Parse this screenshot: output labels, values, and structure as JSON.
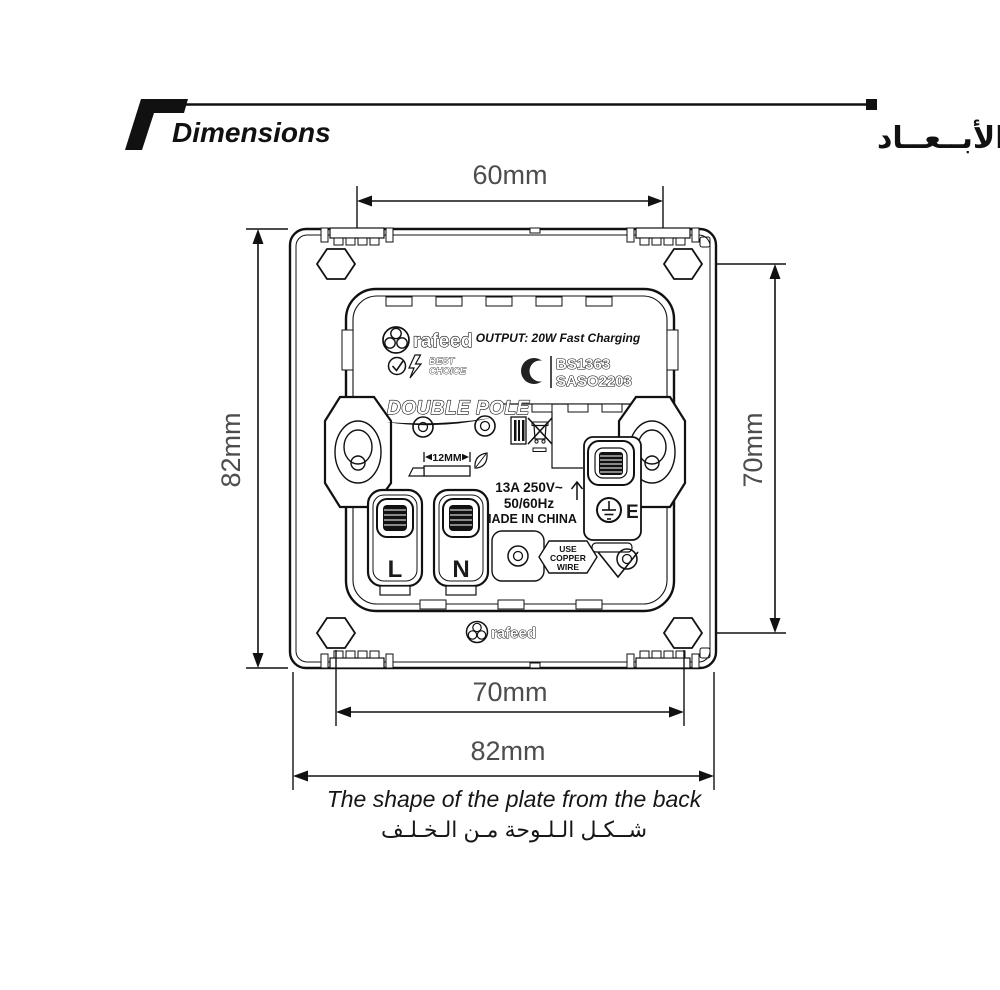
{
  "header": {
    "title_en": "Dimensions",
    "title_ar": "الأبــعــاد"
  },
  "dimensions": {
    "top": "60mm",
    "left": "82mm",
    "right": "70mm",
    "bottom_inner": "70mm",
    "bottom_outer": "82mm"
  },
  "caption": {
    "en": "The shape of the plate from the back",
    "ar": "شــكـل الـلـوحة مـن الـخـلـف"
  },
  "plate": {
    "brand_top": "rafeed",
    "brand_bottom": "rafeed",
    "best": "BEST",
    "choice": "CHOICE",
    "output": "OUTPUT: 20W Fast Charging",
    "cert1": "BS1363",
    "cert2": "SASO2203",
    "pole": "DOUBLE POLE",
    "gauge": "12MM",
    "rating1": "13A 250V~",
    "rating2": "50/60Hz",
    "rating3": "MADE IN CHINA",
    "live": "L",
    "neutral": "N",
    "earth": "E",
    "wire1": "USE",
    "wire2": "COPPER",
    "wire3": "WIRE"
  },
  "colors": {
    "ink": "#111111",
    "dimension_text": "#4d4d4d",
    "background": "#ffffff"
  }
}
